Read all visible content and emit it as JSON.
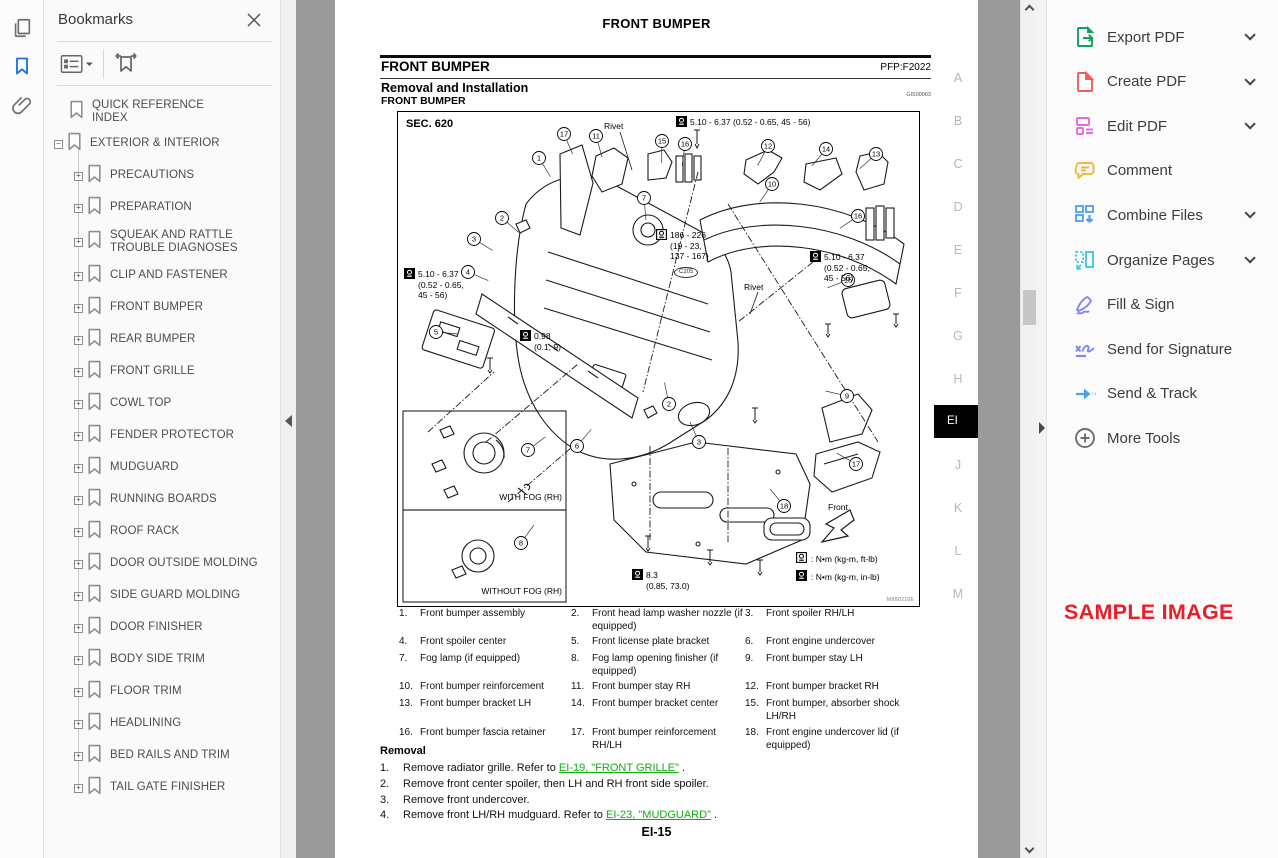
{
  "left_rail": {
    "icons": [
      {
        "name": "page-thumbnails-icon",
        "active": false
      },
      {
        "name": "bookmarks-icon",
        "active": true
      },
      {
        "name": "attachments-icon",
        "active": false
      }
    ],
    "active_color": "#1473e6",
    "inactive_color": "#6e6e6e"
  },
  "bookmarks_panel": {
    "title": "Bookmarks",
    "items": [
      {
        "label": "QUICK REFERENCE INDEX",
        "level": 0,
        "expander": "none"
      },
      {
        "label": "EXTERIOR & INTERIOR",
        "level": 0,
        "expander": "minus"
      },
      {
        "label": "PRECAUTIONS",
        "level": 1,
        "expander": "plus"
      },
      {
        "label": "PREPARATION",
        "level": 1,
        "expander": "plus"
      },
      {
        "label": "SQUEAK AND RATTLE TROUBLE DIAGNOSES",
        "level": 1,
        "expander": "plus"
      },
      {
        "label": "CLIP AND FASTENER",
        "level": 1,
        "expander": "plus"
      },
      {
        "label": "FRONT BUMPER",
        "level": 1,
        "expander": "plus"
      },
      {
        "label": "REAR BUMPER",
        "level": 1,
        "expander": "plus"
      },
      {
        "label": "FRONT GRILLE",
        "level": 1,
        "expander": "plus"
      },
      {
        "label": "COWL TOP",
        "level": 1,
        "expander": "plus"
      },
      {
        "label": "FENDER PROTECTOR",
        "level": 1,
        "expander": "plus"
      },
      {
        "label": "MUDGUARD",
        "level": 1,
        "expander": "plus"
      },
      {
        "label": "RUNNING BOARDS",
        "level": 1,
        "expander": "plus"
      },
      {
        "label": "ROOF RACK",
        "level": 1,
        "expander": "plus"
      },
      {
        "label": "DOOR OUTSIDE MOLDING",
        "level": 1,
        "expander": "plus"
      },
      {
        "label": "SIDE GUARD MOLDING",
        "level": 1,
        "expander": "plus"
      },
      {
        "label": "DOOR FINISHER",
        "level": 1,
        "expander": "plus"
      },
      {
        "label": "BODY SIDE TRIM",
        "level": 1,
        "expander": "plus"
      },
      {
        "label": "FLOOR TRIM",
        "level": 1,
        "expander": "plus"
      },
      {
        "label": "HEADLINING",
        "level": 1,
        "expander": "plus"
      },
      {
        "label": "BED RAILS AND TRIM",
        "level": 1,
        "expander": "plus"
      },
      {
        "label": "TAIL GATE FINISHER",
        "level": 1,
        "expander": "plus"
      }
    ]
  },
  "document": {
    "running_header": "FRONT BUMPER",
    "section_heading": "FRONT BUMPER",
    "pfp_code": "PFP:F2022",
    "subsection_heading": "Removal and Installation",
    "figure_ref": "GIS00063",
    "subsubsection_heading": "FRONT BUMPER",
    "page_number": "EI-15",
    "side_tabs": {
      "letters": [
        "A",
        "B",
        "C",
        "D",
        "E",
        "F",
        "G",
        "H",
        "EI",
        "J",
        "K",
        "L",
        "M"
      ],
      "active": "EI"
    },
    "diagram": {
      "sec_label": "SEC. 620",
      "image_code": "MIIB0216E",
      "front_label": "Front",
      "inset_top_label": "WITH FOG (RH)",
      "inset_bottom_label": "WITHOUT FOG (RH)",
      "legend": [
        {
          "icon": "torque-ftlb-icon",
          "text": ": N•m (kg-m, ft-lb)"
        },
        {
          "icon": "torque-inlb-icon",
          "text": ": N•m (kg-m, in-lb)"
        }
      ],
      "annotations": [
        {
          "icon": "inlb",
          "text": "5.10 - 6.37 (0.52 - 0.65, 45 - 56)",
          "x": 278,
          "y": 5
        },
        {
          "icon": "none",
          "text": "Rivet",
          "x": 206,
          "y": 9
        },
        {
          "icon": "none",
          "text": "Rivet",
          "x": 346,
          "y": 170
        },
        {
          "icon": "ftlb",
          "text": "186 - 226\n(19 - 23,\n137 - 167)",
          "x": 258,
          "y": 118
        },
        {
          "icon": "inlb",
          "text": "5.10 - 6.37\n(0.52 - 0.65,\n45 - 56)",
          "x": 6,
          "y": 157
        },
        {
          "icon": "inlb",
          "text": "0.98\n(0.1, 9)",
          "x": 122,
          "y": 219
        },
        {
          "icon": "inlb",
          "text": "5.10 - 6.37\n(0.52 - 0.65,\n45 - 56)",
          "x": 412,
          "y": 140
        },
        {
          "icon": "inlb",
          "text": "8.3\n(0.85, 73.0)",
          "x": 234,
          "y": 458
        },
        {
          "icon": "oval",
          "text": "C205",
          "x": 276,
          "y": 155
        }
      ],
      "callouts": [
        {
          "n": "1",
          "x": 141,
          "y": 46
        },
        {
          "n": "17",
          "x": 166,
          "y": 22
        },
        {
          "n": "11",
          "x": 198,
          "y": 24
        },
        {
          "n": "15",
          "x": 264,
          "y": 29
        },
        {
          "n": "16",
          "x": 287,
          "y": 32
        },
        {
          "n": "12",
          "x": 370,
          "y": 34
        },
        {
          "n": "14",
          "x": 428,
          "y": 37
        },
        {
          "n": "13",
          "x": 478,
          "y": 42
        },
        {
          "n": "10",
          "x": 374,
          "y": 72
        },
        {
          "n": "16",
          "x": 460,
          "y": 104
        },
        {
          "n": "7",
          "x": 246,
          "y": 86
        },
        {
          "n": "2",
          "x": 104,
          "y": 106
        },
        {
          "n": "3",
          "x": 76,
          "y": 127
        },
        {
          "n": "4",
          "x": 70,
          "y": 160
        },
        {
          "n": "15",
          "x": 450,
          "y": 168
        },
        {
          "n": "5",
          "x": 38,
          "y": 220
        },
        {
          "n": "9",
          "x": 449,
          "y": 284
        },
        {
          "n": "2",
          "x": 271,
          "y": 292
        },
        {
          "n": "3",
          "x": 301,
          "y": 330
        },
        {
          "n": "6",
          "x": 179,
          "y": 334
        },
        {
          "n": "7",
          "x": 130,
          "y": 338
        },
        {
          "n": "17",
          "x": 458,
          "y": 352
        },
        {
          "n": "18",
          "x": 386,
          "y": 394
        },
        {
          "n": "8",
          "x": 123,
          "y": 431
        }
      ]
    },
    "parts": [
      {
        "num": "1.",
        "label": "Front bumper assembly"
      },
      {
        "num": "2.",
        "label": "Front head lamp washer nozzle (if equipped)"
      },
      {
        "num": "3.",
        "label": "Front spoiler RH/LH"
      },
      {
        "num": "4.",
        "label": "Front spoiler center"
      },
      {
        "num": "5.",
        "label": "Front license plate bracket"
      },
      {
        "num": "6.",
        "label": "Front engine undercover"
      },
      {
        "num": "7.",
        "label": "Fog lamp (if equipped)"
      },
      {
        "num": "8.",
        "label": "Fog lamp opening finisher (if equipped)"
      },
      {
        "num": "9.",
        "label": "Front bumper stay LH"
      },
      {
        "num": "10.",
        "label": "Front bumper reinforcement"
      },
      {
        "num": "11.",
        "label": "Front bumper stay RH"
      },
      {
        "num": "12.",
        "label": "Front bumper bracket RH"
      },
      {
        "num": "13.",
        "label": "Front bumper bracket LH"
      },
      {
        "num": "14.",
        "label": "Front bumper bracket center"
      },
      {
        "num": "15.",
        "label": "Front bumper, absorber shock LH/RH"
      },
      {
        "num": "16.",
        "label": "Front bumper fascia retainer"
      },
      {
        "num": "17.",
        "label": "Front bumper reinforcement RH/LH"
      },
      {
        "num": "18.",
        "label": "Front engine undercover lid (if equipped)"
      }
    ],
    "removal": {
      "heading": "Removal",
      "link_color": "#12ad12",
      "steps": [
        {
          "num": "1.",
          "pre": "Remove radiator grille. Refer to ",
          "link": "EI-19, \"FRONT GRILLE\"",
          "post": " ."
        },
        {
          "num": "2.",
          "pre": "Remove front center spoiler, then LH and RH front side spoiler.",
          "link": "",
          "post": ""
        },
        {
          "num": "3.",
          "pre": "Remove front undercover.",
          "link": "",
          "post": ""
        },
        {
          "num": "4.",
          "pre": "Remove front LH/RH mudguard. Refer to ",
          "link": "EI-23, \"MUDGUARD\"",
          "post": " ."
        }
      ]
    }
  },
  "tools_panel": {
    "items": [
      {
        "label": "Export PDF",
        "icon": "export-pdf-icon",
        "chevron": true,
        "color": "#0da263"
      },
      {
        "label": "Create PDF",
        "icon": "create-pdf-icon",
        "chevron": true,
        "color": "#ee6055"
      },
      {
        "label": "Edit PDF",
        "icon": "edit-pdf-icon",
        "chevron": true,
        "color": "#dd6fdd"
      },
      {
        "label": "Comment",
        "icon": "comment-icon",
        "chevron": false,
        "color": "#f0b93c"
      },
      {
        "label": "Combine Files",
        "icon": "combine-files-icon",
        "chevron": true,
        "color": "#4aa0ef"
      },
      {
        "label": "Organize Pages",
        "icon": "organize-pages-icon",
        "chevron": true,
        "color": "#39c7d6"
      },
      {
        "label": "Fill & Sign",
        "icon": "fill-sign-icon",
        "chevron": false,
        "color": "#8186f0"
      },
      {
        "label": "Send for Signature",
        "icon": "send-signature-icon",
        "chevron": false,
        "color": "#8186f0"
      },
      {
        "label": "Send & Track",
        "icon": "send-track-icon",
        "chevron": false,
        "color": "#4aa0ef"
      },
      {
        "label": "More Tools",
        "icon": "more-tools-icon",
        "chevron": false,
        "color": "#6d6d6d"
      }
    ],
    "watermark": "SAMPLE IMAGE",
    "watermark_color": "#ec1c28"
  }
}
